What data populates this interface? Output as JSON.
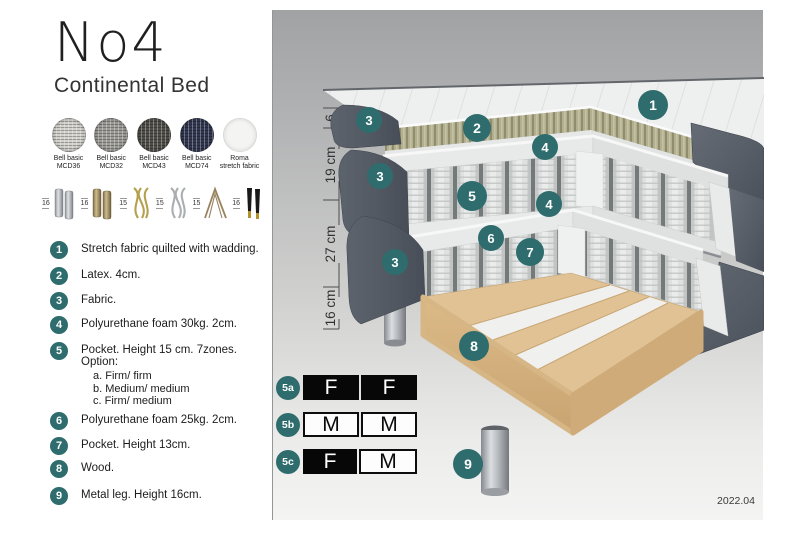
{
  "header": {
    "title": "No4",
    "subtitle": "Continental Bed"
  },
  "swatches": [
    {
      "line1": "Bell basic",
      "line2": "MCD36"
    },
    {
      "line1": "Bell basic",
      "line2": "MCD32"
    },
    {
      "line1": "Bell basic",
      "line2": "MCD43"
    },
    {
      "line1": "Bell basic",
      "line2": "MCD74"
    },
    {
      "line1": "Roma",
      "line2": "stretch fabric"
    }
  ],
  "legs_options": [
    {
      "height": "16",
      "type": "cylinder-silver"
    },
    {
      "height": "16",
      "type": "cylinder-brass"
    },
    {
      "height": "15",
      "type": "twisted-gold"
    },
    {
      "height": "15",
      "type": "twisted-silver"
    },
    {
      "height": "15",
      "type": "hairpin"
    },
    {
      "height": "16",
      "type": "tapered-black-gold"
    }
  ],
  "parts_list": [
    {
      "num": "1",
      "text": "Stretch fabric quilted with wadding."
    },
    {
      "num": "2",
      "text": "Latex. 4cm."
    },
    {
      "num": "3",
      "text": "Fabric."
    },
    {
      "num": "4",
      "text": "Polyurethane foam 30kg. 2cm."
    },
    {
      "num": "5",
      "text": "Pocket. Height 15 cm. 7zones. Option:",
      "options": [
        "a. Firm/ firm",
        "b. Medium/ medium",
        "c. Firm/ medium"
      ]
    },
    {
      "num": "6",
      "text": "Polyurethane foam 25kg. 2cm."
    },
    {
      "num": "7",
      "text": "Pocket. Height 13cm."
    },
    {
      "num": "8",
      "text": "Wood."
    },
    {
      "num": "9",
      "text": "Metal leg. Height 16cm."
    }
  ],
  "diagram": {
    "ruler": [
      "6",
      "19 cm",
      "27 cm",
      "16 cm"
    ],
    "callouts": [
      "1",
      "2",
      "3",
      "4",
      "3",
      "5",
      "4",
      "6",
      "7",
      "3",
      "8",
      "9"
    ]
  },
  "firmness": {
    "rows": [
      {
        "id": "5a",
        "cells": [
          {
            "label": "F",
            "variant": "dark"
          },
          {
            "label": "F",
            "variant": "dark"
          }
        ]
      },
      {
        "id": "5b",
        "cells": [
          {
            "label": "M",
            "variant": "light"
          },
          {
            "label": "M",
            "variant": "light"
          }
        ]
      },
      {
        "id": "5c",
        "cells": [
          {
            "label": "F",
            "variant": "dark"
          },
          {
            "label": "M",
            "variant": "light"
          }
        ]
      }
    ]
  },
  "version": "2022.04",
  "colors": {
    "accent_teal": "#2e6c6d",
    "fabric_dark": "#575d67",
    "latex": "#b2af90",
    "wood": "#ddbe92",
    "metal_leg": "#b7bbbf"
  }
}
